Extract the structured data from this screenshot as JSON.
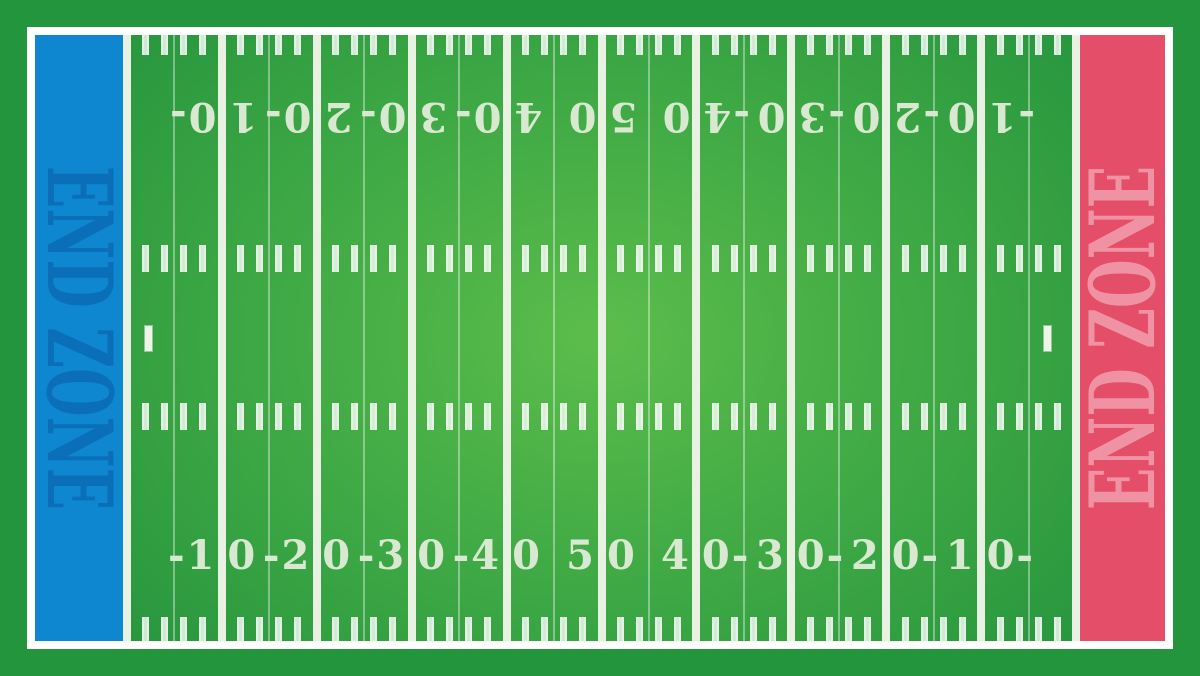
{
  "title": "American football field illustration",
  "colors": {
    "outer_border": "#22953d",
    "frame": "#ffffff",
    "field_center": "#5cbd4b",
    "field_mid": "#3ca744",
    "field_edge": "#23923d",
    "yard_line": "#e9f2e2",
    "five_yard_line": "rgba(255,255,255,0.38)",
    "hash_outer": "rgba(255,255,255,0.40)",
    "hash_inner": "rgba(255,255,255,0.78)",
    "number": "#d9e9d1",
    "tick": "#eef5e8",
    "endzone_left_bg": "#0e86d0",
    "endzone_left_text": "#0a6fb8",
    "endzone_right_bg": "#e54e68",
    "endzone_right_text": "#ef93a4"
  },
  "end_zones": {
    "left_label": "END ZONE",
    "right_label": "END ZONE"
  },
  "yard_numbers": {
    "top_row_note": "rotated 180 degrees",
    "top": [
      {
        "left_part": "1",
        "right_part": "0-"
      },
      {
        "left_part": "2",
        "right_part": "0-"
      },
      {
        "left_part": "3",
        "right_part": "0-"
      },
      {
        "left_part": "4",
        "right_part": "0-"
      },
      {
        "left_part": "5",
        "right_part": "0"
      },
      {
        "left_part": "-4",
        "right_part": "0"
      },
      {
        "left_part": "-3",
        "right_part": "0"
      },
      {
        "left_part": "-2",
        "right_part": "0"
      },
      {
        "left_part": "-1",
        "right_part": "0"
      }
    ],
    "bottom": [
      {
        "left_part": "-1",
        "right_part": "0"
      },
      {
        "left_part": "-2",
        "right_part": "0"
      },
      {
        "left_part": "-3",
        "right_part": "0"
      },
      {
        "left_part": "-4",
        "right_part": "0"
      },
      {
        "left_part": "5",
        "right_part": "0"
      },
      {
        "left_part": "4",
        "right_part": "0-"
      },
      {
        "left_part": "3",
        "right_part": "0-"
      },
      {
        "left_part": "2",
        "right_part": "0-"
      },
      {
        "left_part": "1",
        "right_part": "0-"
      }
    ]
  },
  "geometry": {
    "canvas_width": 1200,
    "canvas_height": 676,
    "margin": 27,
    "frame_thickness": 8,
    "field_width": 1130,
    "field_height": 606,
    "goal_line_left_x": 92,
    "goal_line_right_x": 1041,
    "yard_line_width": 8,
    "five_yard_line_width": 2,
    "hash_width": 7,
    "hashes_per_ten_yards": 5,
    "hash_rows": [
      {
        "y": -4,
        "h": 24
      },
      {
        "y": 210,
        "h": 27
      },
      {
        "y": 368,
        "h": 27
      },
      {
        "y": 582,
        "h": 27
      }
    ],
    "number_row_top_center_y": 81,
    "number_row_bottom_center_y": 521,
    "center_tick_y": 289.5,
    "center_tick_w": 9,
    "center_tick_h": 27,
    "center_ticks_x": [
      113,
      1012
    ]
  }
}
